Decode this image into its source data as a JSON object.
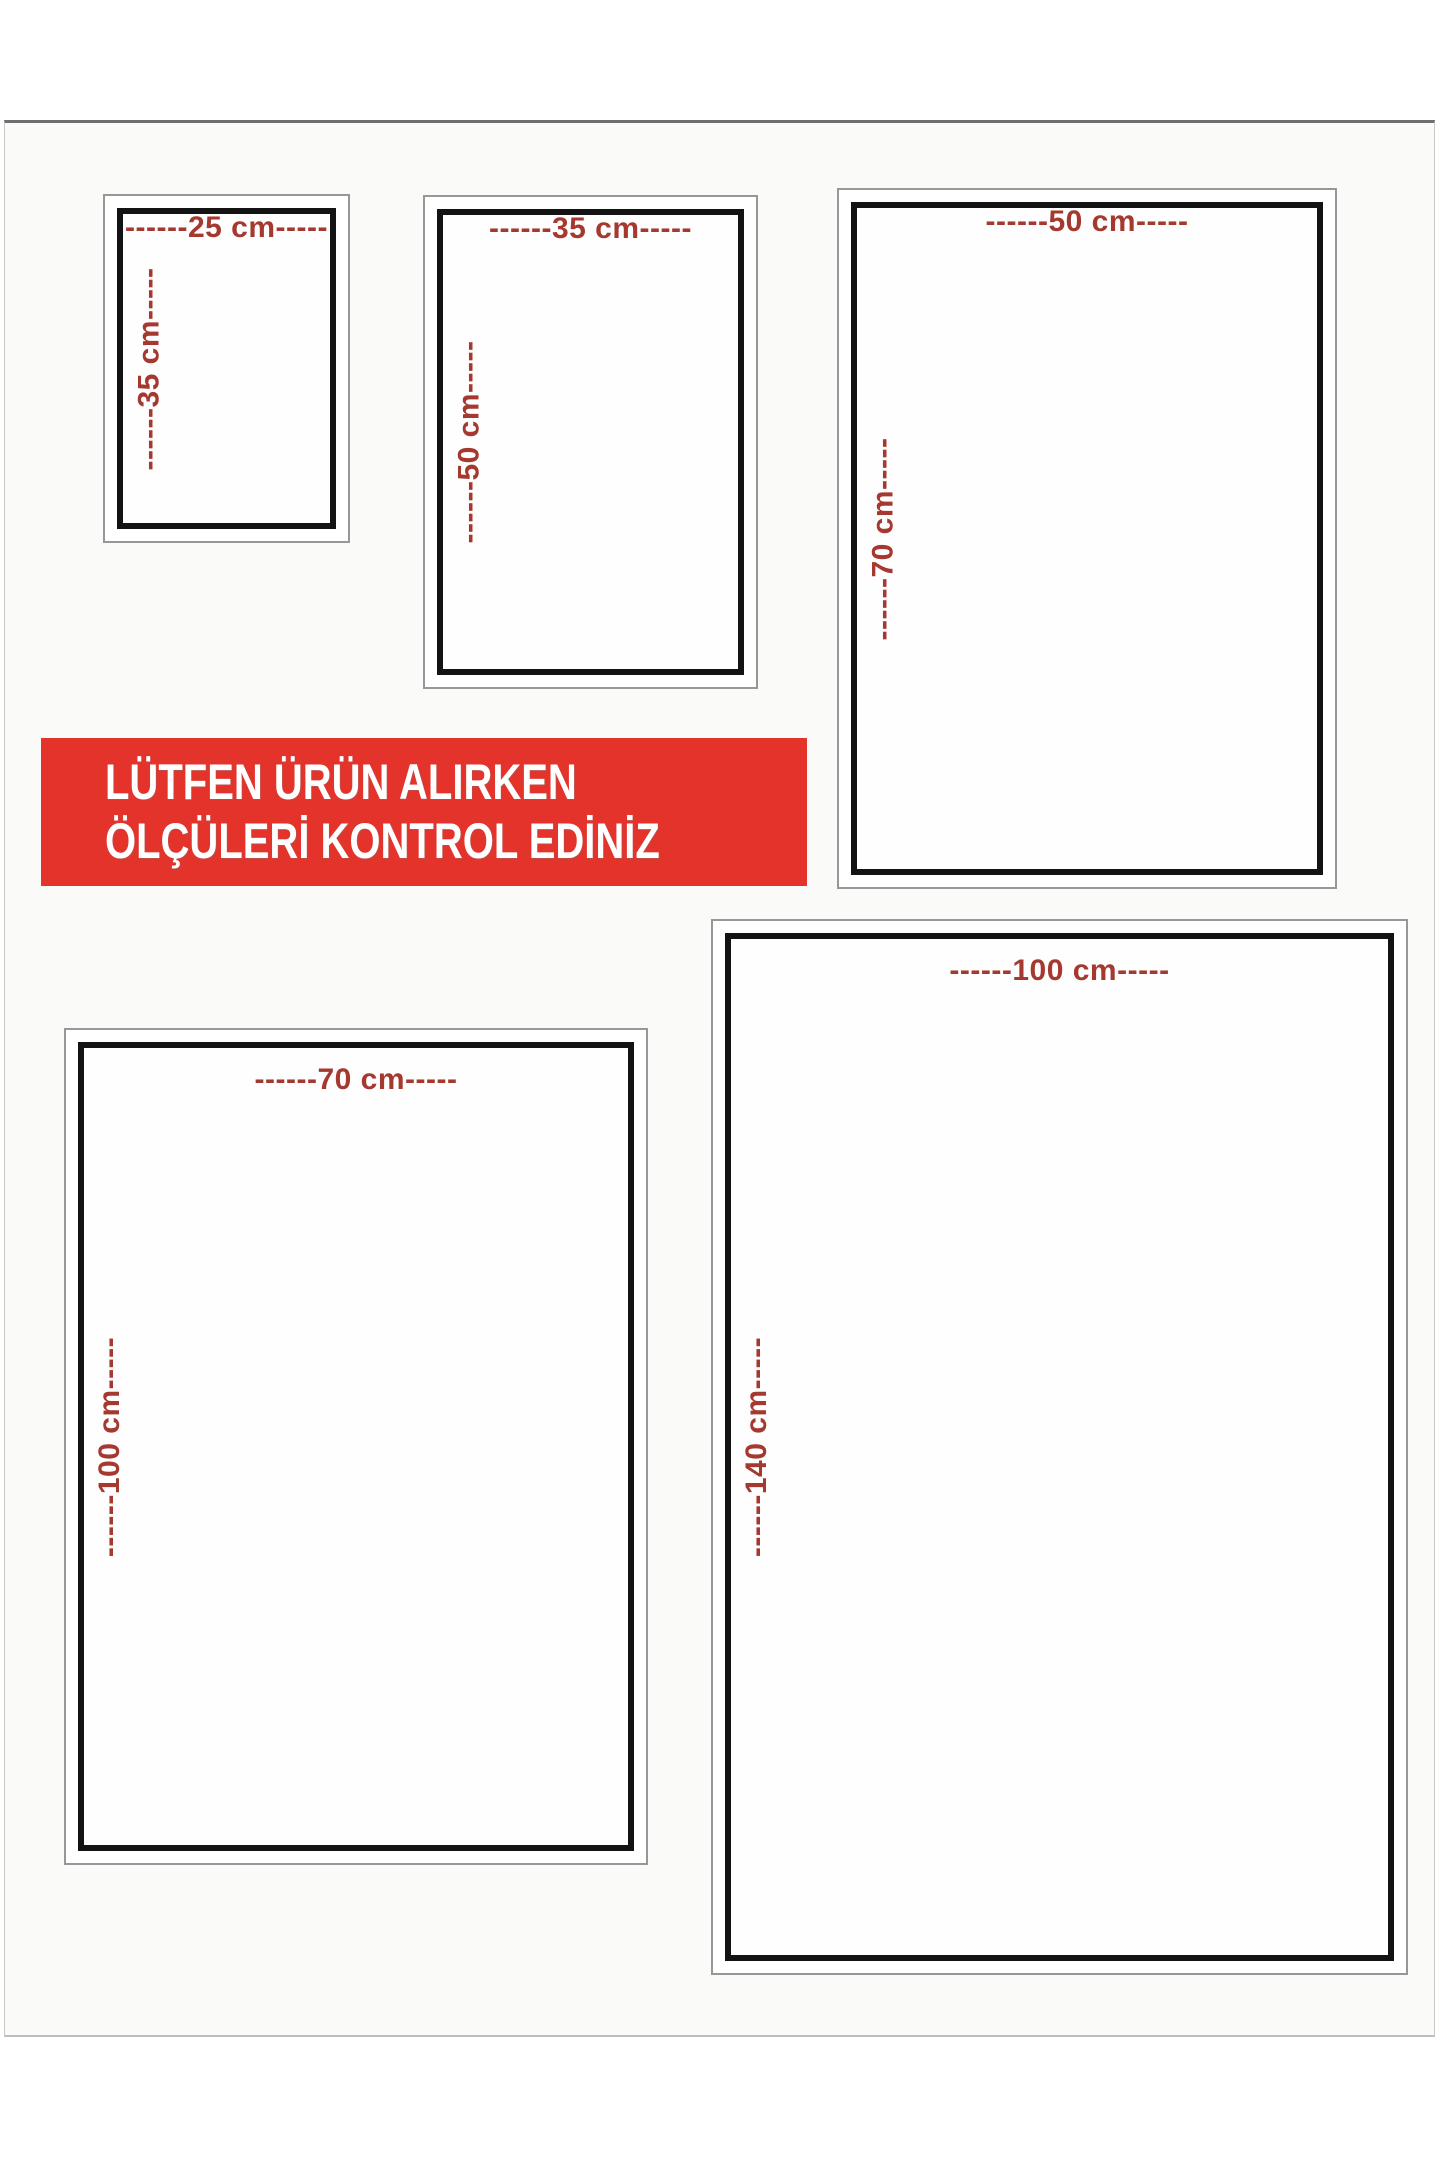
{
  "banner": {
    "line1": "LÜTFEN ÜRÜN ALIRKEN",
    "line2": "ÖLÇÜLERİ KONTROL EDİNİZ"
  },
  "sizes": [
    {
      "width_label": "------25 cm-----",
      "height_label": "------35 cm-----"
    },
    {
      "width_label": "------35 cm-----",
      "height_label": "------50 cm-----"
    },
    {
      "width_label": "------50 cm-----",
      "height_label": "------70 cm-----"
    },
    {
      "width_label": "------70 cm-----",
      "height_label": "------100 cm-----"
    },
    {
      "width_label": "------100 cm-----",
      "height_label": "------140 cm-----"
    }
  ],
  "colors": {
    "banner_red": "#e3332b",
    "label_red": "#a5382f",
    "box_border": "#131313",
    "outer_border": "#979797"
  }
}
